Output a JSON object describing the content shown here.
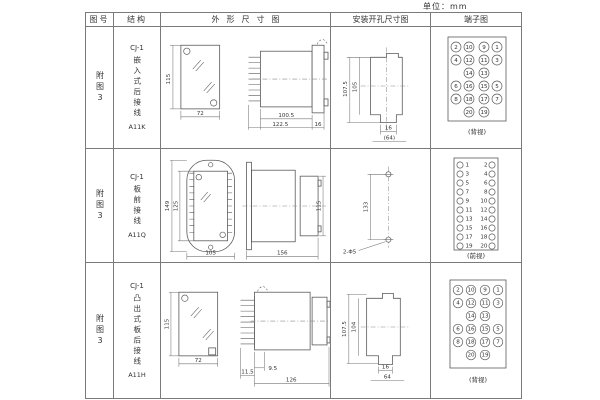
{
  "unit_label": "单位：mm",
  "table": {
    "headers": [
      "图号",
      "结构",
      "外形尺寸图",
      "安装开孔尺寸图",
      "端子图"
    ],
    "rows": [
      {
        "figure_no": "附图3",
        "structure": {
          "model": "CJ-1",
          "desc": "嵌入式后接线",
          "code": "A11K"
        },
        "outline": {
          "front_height": "115",
          "front_width": "72",
          "body_length": "100.5",
          "total_length": "122.5",
          "flange_depth": "16"
        },
        "install": {
          "outer_height": "107.5",
          "inner_height": "105",
          "notch_width": "16",
          "span": "(64)"
        },
        "terminal": {
          "caption": "(背视)",
          "layout": "grid4",
          "grid": [
            [
              "2",
              "10",
              "9",
              "1"
            ],
            [
              "4",
              "12",
              "11",
              "3"
            ],
            [
              null,
              "14",
              "13",
              null
            ],
            [
              "6",
              "16",
              "15",
              "5"
            ],
            [
              "8",
              "18",
              "17",
              "7"
            ],
            [
              null,
              "20",
              "19",
              null
            ]
          ]
        }
      },
      {
        "figure_no": "附图3",
        "structure": {
          "model": "CJ-1",
          "desc": "板前接线",
          "code": "A11Q"
        },
        "outline": {
          "front_outer_height": "149",
          "front_inner_height": "125",
          "front_width": "105",
          "side_length": "156",
          "side_height": "115"
        },
        "install": {
          "hole_span": "133",
          "holes_label": "2-Φ5"
        },
        "terminal": {
          "caption": "(前视)",
          "layout": "cols2",
          "pairs": [
            [
              "1",
              "2"
            ],
            [
              "3",
              "4"
            ],
            [
              "5",
              "6"
            ],
            [
              "7",
              "8"
            ],
            [
              "9",
              "10"
            ],
            [
              "11",
              "12"
            ],
            [
              "13",
              "14"
            ],
            [
              "15",
              "16"
            ],
            [
              "17",
              "18"
            ],
            [
              "19",
              "20"
            ]
          ]
        }
      },
      {
        "figure_no": "附图3",
        "structure": {
          "model": "CJ-1",
          "desc": "凸出式板后接线",
          "code": "A11H"
        },
        "outline": {
          "front_height": "115",
          "front_width": "72",
          "blade_depth": "11.5",
          "stub_depth": "9.5",
          "body_length": "126"
        },
        "install": {
          "outer_height": "107.5",
          "inner_height": "104",
          "notch_width": "16",
          "span": "64"
        },
        "terminal": {
          "caption": "(背视)",
          "layout": "grid4",
          "grid": [
            [
              "2",
              "10",
              "9",
              "1"
            ],
            [
              "4",
              "12",
              "11",
              "3"
            ],
            [
              null,
              "14",
              "13",
              null
            ],
            [
              "6",
              "16",
              "15",
              "5"
            ],
            [
              "8",
              "18",
              "17",
              "7"
            ],
            [
              null,
              "20",
              "19",
              null
            ]
          ]
        }
      }
    ]
  }
}
